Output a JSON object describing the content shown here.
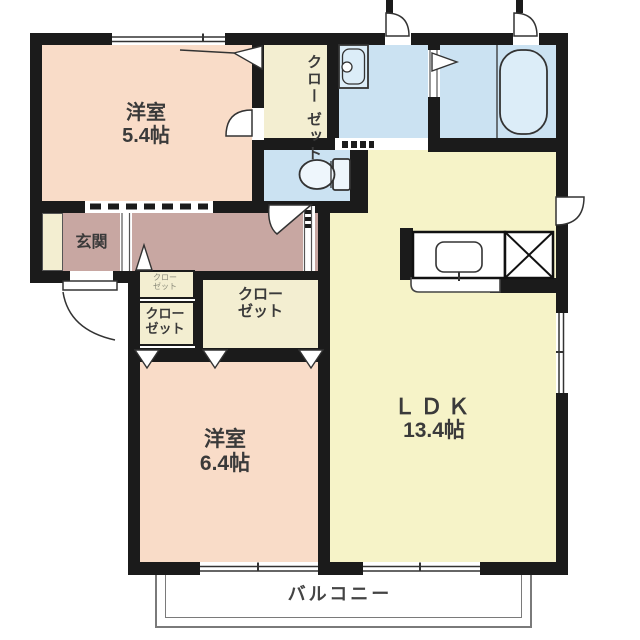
{
  "plan": {
    "type": "floorplan",
    "labels": {
      "bedroom1": {
        "name": "洋室",
        "size": "5.4帖"
      },
      "bedroom2": {
        "name": "洋室",
        "size": "6.4帖"
      },
      "ldk": {
        "name": "ＬＤＫ",
        "size": "13.4帖"
      },
      "entrance": {
        "name": "玄関"
      },
      "balcony": {
        "name": "バルコニー"
      },
      "closet_bedroom1": {
        "l1": "クロー",
        "l2": "ゼット"
      },
      "closet_middle": {
        "l1": "クロー",
        "l2": "ゼット"
      },
      "closet_small_top": {
        "l1": "クロー",
        "l2": "ゼット"
      },
      "closet_small_bottom": {
        "l1": "クロー",
        "l2": "ゼット"
      }
    },
    "fixtures": [
      "bathtub",
      "washbasin",
      "toilet",
      "kitchen-sink-counter",
      "refrigerator-space-x"
    ],
    "colors": {
      "wall": "#1b1b1b",
      "bedroom_pink": "#f9dcc8",
      "ldk_yellow": "#f6f3c8",
      "closet_cream": "#f3eed1",
      "hall_mauve": "#c8a7a2",
      "wet_blue": "#cbe2f2",
      "fixture_blue": "#dcedf8",
      "balcony_line": "#7a7a7a",
      "text": "#3a3a3a"
    }
  }
}
